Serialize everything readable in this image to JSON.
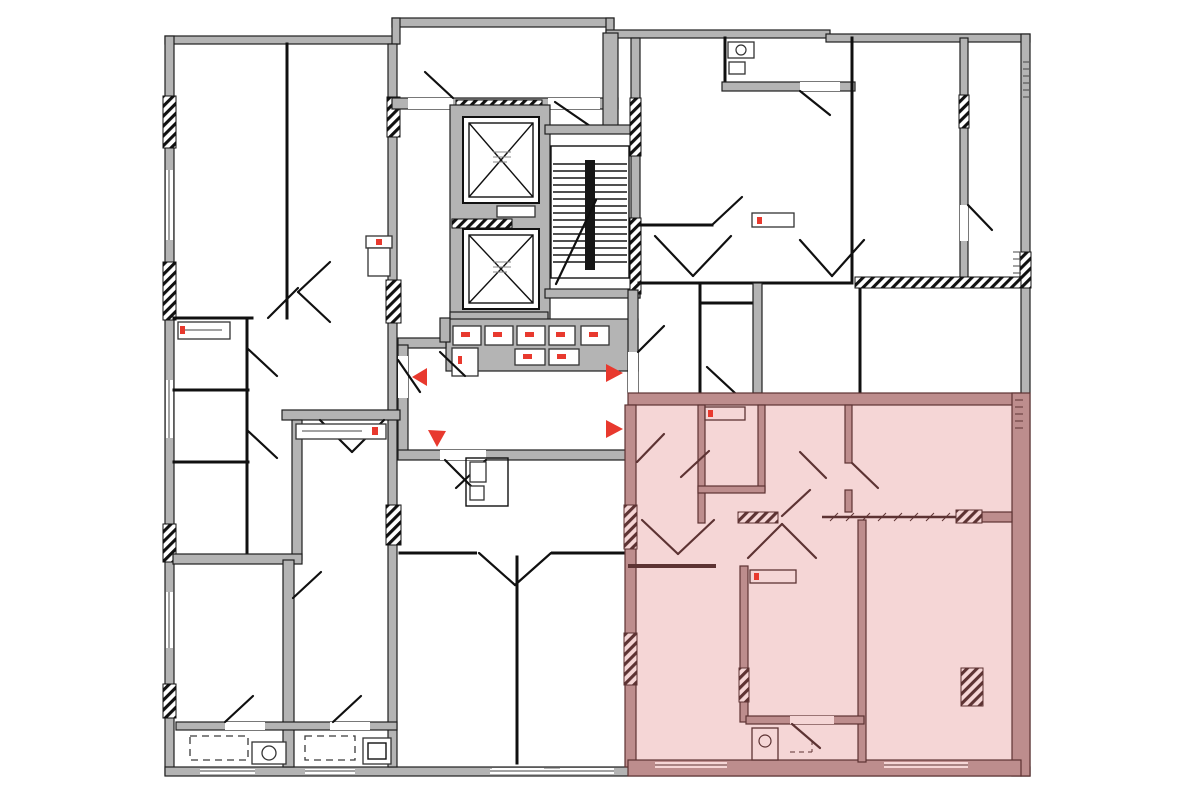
{
  "canvas": {
    "width": 1200,
    "height": 800,
    "background": "#ffffff"
  },
  "colors": {
    "background": "#ffffff",
    "wall_fill": "#b4b4b4",
    "wall_stroke": "#1f1f1f",
    "partition": "#101010",
    "highlight_fill": "#f5d6d6",
    "highlight_wall_fill": "#bd8d8d",
    "highlight_wall_stroke": "#5d3333",
    "accent_red": "#e8392e"
  },
  "plan": {
    "type": "residential-floor-plan",
    "highlighted_apartment": {
      "position": "bottom-right",
      "selected": true
    },
    "elevator_count": 2,
    "staircase_count": 1,
    "entrance_arrow_count": 4,
    "entrance_arrows": [
      {
        "wall": "lobby-left",
        "direction": "left"
      },
      {
        "wall": "lobby-bottom",
        "direction": "down"
      },
      {
        "wall": "lobby-right-upper",
        "direction": "right"
      },
      {
        "wall": "lobby-right-lower",
        "direction": "right"
      }
    ]
  }
}
